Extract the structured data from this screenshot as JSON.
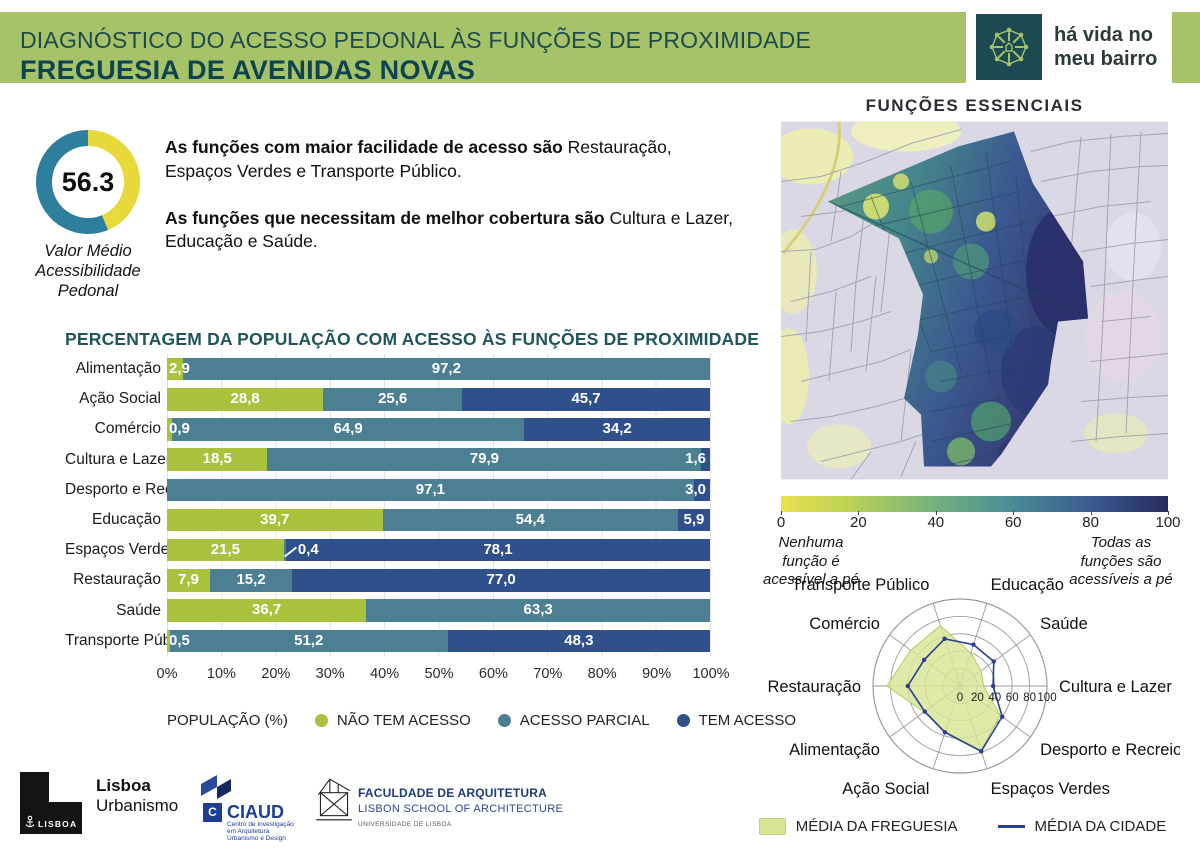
{
  "header": {
    "title_line1": "DIAGNÓSTICO DO ACESSO PEDONAL ÀS FUNÇÕES DE PROXIMIDADE",
    "title_line2": "FREGUESIA DE AVENIDAS NOVAS",
    "brand": {
      "line1": "há vida no",
      "line2": "meu bairro"
    }
  },
  "summary": {
    "donut_value": "56.3",
    "caption_lines": [
      "Valor Médio",
      "Acessibilidade",
      "Pedonal"
    ],
    "paragraph1_bold": "As funções com maior facilidade de acesso são",
    "paragraph1_rest": " Restauração, Espaços Verdes e Transporte Público.",
    "paragraph2_bold": "As funções que necessitam de melhor cobertura são",
    "paragraph2_rest": " Cultura e Lazer, Educação e Saúde."
  },
  "colors": {
    "accent_green": "#a6c368",
    "bar_nao": "#a9c23d",
    "bar_parcial": "#4d7f92",
    "bar_tem": "#30508c",
    "donut_teal": "#2e7e9e",
    "donut_yellow": "#e7d83b",
    "city_line": "#2b3f8f",
    "freguesia_fill": "#d8e596"
  },
  "chart_data": [
    {
      "type": "pie",
      "variant": "donut",
      "center_label": "56.3",
      "slices": [
        {
          "label": "Valor Médio Acessibilidade Pedonal",
          "value": 56.3,
          "color": "#2e7e9e"
        },
        {
          "label": "restante",
          "value": 43.7,
          "color": "#e7d83b"
        }
      ]
    },
    {
      "type": "bar",
      "stacked": true,
      "orientation": "horizontal",
      "title": "PERCENTAGEM DA POPULAÇÃO COM ACESSO ÀS FUNÇÕES DE PROXIMIDADE",
      "legend_title": "POPULAÇÃO (%)",
      "series_names": [
        "NÃO TEM ACESSO",
        "ACESSO PARCIAL",
        "TEM ACESSO"
      ],
      "series_keys": [
        "nao",
        "parcial",
        "tem"
      ],
      "series_colors": [
        "#a9c23d",
        "#4d7f92",
        "#30508c"
      ],
      "xlim": [
        0,
        100
      ],
      "x_ticks": [
        "0%",
        "10%",
        "20%",
        "30%",
        "40%",
        "50%",
        "60%",
        "70%",
        "80%",
        "90%",
        "100%"
      ],
      "rows": [
        {
          "category": "Alimentação",
          "nao": 2.9,
          "parcial": 97.2,
          "tem": 0,
          "nao_label": "2,9",
          "parcial_label": "97,2",
          "tem_label": "",
          "nao_pos": "overflow-left",
          "parcial_pos": "in",
          "tem_pos": "none"
        },
        {
          "category": "Ação Social",
          "nao": 28.8,
          "parcial": 25.6,
          "tem": 45.7,
          "nao_label": "28,8",
          "parcial_label": "25,6",
          "tem_label": "45,7",
          "nao_pos": "in",
          "parcial_pos": "in",
          "tem_pos": "in"
        },
        {
          "category": "Comércio",
          "nao": 0.9,
          "parcial": 64.9,
          "tem": 34.2,
          "nao_label": "0,9",
          "parcial_label": "64,9",
          "tem_label": "34,2",
          "nao_pos": "overflow-left",
          "parcial_pos": "in",
          "tem_pos": "in"
        },
        {
          "category": "Cultura e Lazer",
          "nao": 18.5,
          "parcial": 79.9,
          "tem": 1.6,
          "nao_label": "18,5",
          "parcial_label": "79,9",
          "tem_label": "1,6",
          "nao_pos": "in",
          "parcial_pos": "in",
          "tem_pos": "overflow-right"
        },
        {
          "category": "Desporto e Recreio",
          "nao": 0,
          "parcial": 97.1,
          "tem": 3.0,
          "nao_label": "",
          "parcial_label": "97,1",
          "tem_label": "3,0",
          "nao_pos": "none",
          "parcial_pos": "in",
          "tem_pos": "overflow-right"
        },
        {
          "category": "Educação",
          "nao": 39.7,
          "parcial": 54.4,
          "tem": 5.9,
          "nao_label": "39,7",
          "parcial_label": "54,4",
          "tem_label": "5,9",
          "nao_pos": "in",
          "parcial_pos": "in",
          "tem_pos": "in"
        },
        {
          "category": "Espaços Verdes",
          "nao": 21.5,
          "parcial": 0.4,
          "tem": 78.1,
          "nao_label": "21,5",
          "parcial_label": "0,4",
          "tem_label": "78,1",
          "nao_pos": "in",
          "parcial_pos": "callout",
          "tem_pos": "in"
        },
        {
          "category": "Restauração",
          "nao": 7.9,
          "parcial": 15.2,
          "tem": 77.0,
          "nao_label": "7,9",
          "parcial_label": "15,2",
          "tem_label": "77,0",
          "nao_pos": "in",
          "parcial_pos": "in",
          "tem_pos": "in"
        },
        {
          "category": "Saúde",
          "nao": 36.7,
          "parcial": 63.3,
          "tem": 0,
          "nao_label": "36,7",
          "parcial_label": "63,3",
          "tem_label": "",
          "nao_pos": "in",
          "parcial_pos": "in",
          "tem_pos": "none"
        },
        {
          "category": "Transporte Público",
          "nao": 0.5,
          "parcial": 51.2,
          "tem": 48.3,
          "nao_label": "0,5",
          "parcial_label": "51,2",
          "tem_label": "48,3",
          "nao_pos": "overflow-left",
          "parcial_pos": "in",
          "tem_pos": "in"
        }
      ]
    },
    {
      "type": "heatmap",
      "title": "FUNÇÕES ESSENCIAIS",
      "scale": {
        "min": 0,
        "max": 100,
        "ticks": [
          "0",
          "20",
          "40",
          "60",
          "80",
          "100"
        ],
        "gradient": [
          "#e9e04e",
          "#bcd156",
          "#72b17e",
          "#4a8b96",
          "#3b5b91",
          "#272a5c"
        ],
        "min_label_lines": [
          "Nenhuma",
          "função é",
          "acessível a pé"
        ],
        "max_label_lines": [
          "Todas as",
          "funções são",
          "acessíveis a pé"
        ]
      }
    },
    {
      "type": "radar",
      "rlim": [
        0,
        100
      ],
      "r_ticks": [
        "0",
        "20",
        "40",
        "60",
        "80",
        "100"
      ],
      "categories": [
        "Educação",
        "Saúde",
        "Cultura e Lazer",
        "Desporto e Recreio",
        "Espaços Verdes",
        "Ação Social",
        "Alimentação",
        "Restauração",
        "Comércio",
        "Transporte Público"
      ],
      "angles_deg": [
        72,
        36,
        0,
        -36,
        -72,
        -108,
        -144,
        180,
        144,
        108
      ],
      "series": [
        {
          "name": "MÉDIA DA FREGUESIA",
          "style": "filled",
          "color": "#d8e596",
          "values": [
            40,
            30,
            27,
            57,
            78,
            55,
            51,
            84,
            70,
            73
          ]
        },
        {
          "name": "MÉDIA DA CIDADE",
          "style": "line",
          "color": "#2b3f8f",
          "values": [
            50,
            48,
            38,
            60,
            79,
            56,
            50,
            60,
            51,
            57
          ]
        }
      ]
    }
  ],
  "footer": {
    "lisboa": {
      "block_label": "LISBOA",
      "line1": "Lisboa",
      "line2": "Urbanismo"
    },
    "ciaud": {
      "letter": "C",
      "name": "CIAUD",
      "desc_lines": [
        "Centro de Investigação",
        "em Arquitetura",
        "Urbanismo e Design"
      ]
    },
    "fa": {
      "line1": "FACULDADE DE ARQUITETURA",
      "line2": "LISBON SCHOOL OF ARCHITECTURE",
      "line3": "UNIVERSIDADE DE LISBOA"
    }
  }
}
